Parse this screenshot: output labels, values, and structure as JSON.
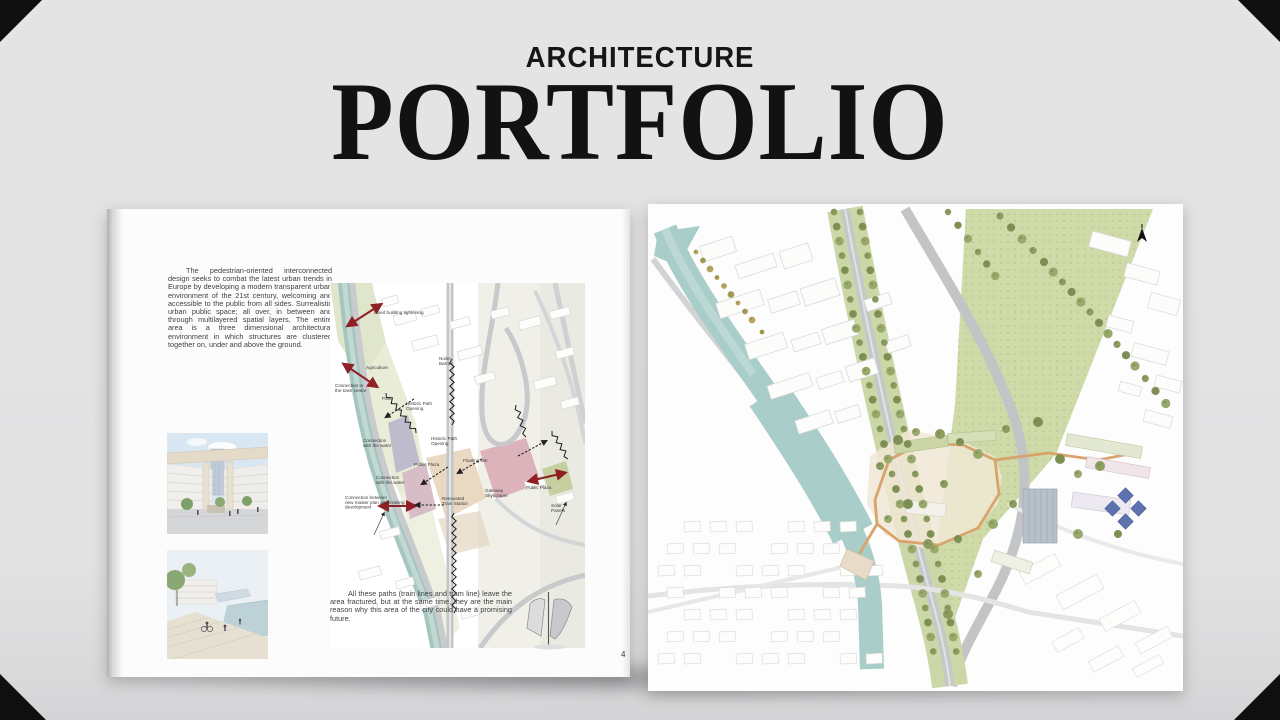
{
  "title": {
    "kicker": "ARCHITECTURE",
    "main": "PORTFOLIO"
  },
  "left_page": {
    "intro": "The pedestrian-oriented interconnected design seeks to combat the latest urban trends in Europe by  developing a modern transparent urban environment of the 21st century, welcoming and accessible to the public from all sides. Surrealistic urban public space; all over,  in between and through multilayered spatial layers,   The entire area is a three dimensional architectural environment in which structures are clustered together on, under and above the ground.",
    "outro": "All these paths (train lines and tram line) leave the area fractured, but at the same time, they are the main reason why this area of the city could have a promising future.",
    "page_number": "4",
    "diagram": {
      "labels": [
        {
          "lines": [
            "Lined building tightening"
          ],
          "x": 44,
          "y": 31
        },
        {
          "lines": [
            "Noise",
            "Barrier"
          ],
          "x": 109,
          "y": 77
        },
        {
          "lines": [
            "Agriculture"
          ],
          "x": 36,
          "y": 86
        },
        {
          "lines": [
            "Connection to",
            "the town centre"
          ],
          "x": 5,
          "y": 104
        },
        {
          "lines": [
            "Park"
          ],
          "x": 52,
          "y": 117
        },
        {
          "lines": [
            "Historic Path",
            "Opening"
          ],
          "x": 76,
          "y": 122
        },
        {
          "lines": [
            "Historic Path",
            "Opening"
          ],
          "x": 101,
          "y": 157
        },
        {
          "lines": [
            "Connection",
            "with the water"
          ],
          "x": 33,
          "y": 159
        },
        {
          "lines": [
            "Public Plaza"
          ],
          "x": 84,
          "y": 183
        },
        {
          "lines": [
            "Floating link"
          ],
          "x": 133,
          "y": 179
        },
        {
          "lines": [
            "Connection",
            "with the water"
          ],
          "x": 46,
          "y": 196
        },
        {
          "lines": [
            "Connection between",
            "new master plan and existing",
            "development"
          ],
          "x": 15,
          "y": 216
        },
        {
          "lines": [
            "Renovated",
            "Train Station"
          ],
          "x": 112,
          "y": 217
        },
        {
          "lines": [
            "Gateway",
            "Skyscraper"
          ],
          "x": 155,
          "y": 209
        },
        {
          "lines": [
            "Public Plaza"
          ],
          "x": 196,
          "y": 206
        },
        {
          "lines": [
            "Solar",
            "Panels"
          ],
          "x": 221,
          "y": 224
        }
      ]
    }
  },
  "colors": {
    "accent_red": "#8e2026",
    "river": "#a9cdc9",
    "grass": "#cfdaa9",
    "tree": "#8c9c5f",
    "path_tan": "#d8a46c",
    "solar_blue": "#5d72ae"
  }
}
